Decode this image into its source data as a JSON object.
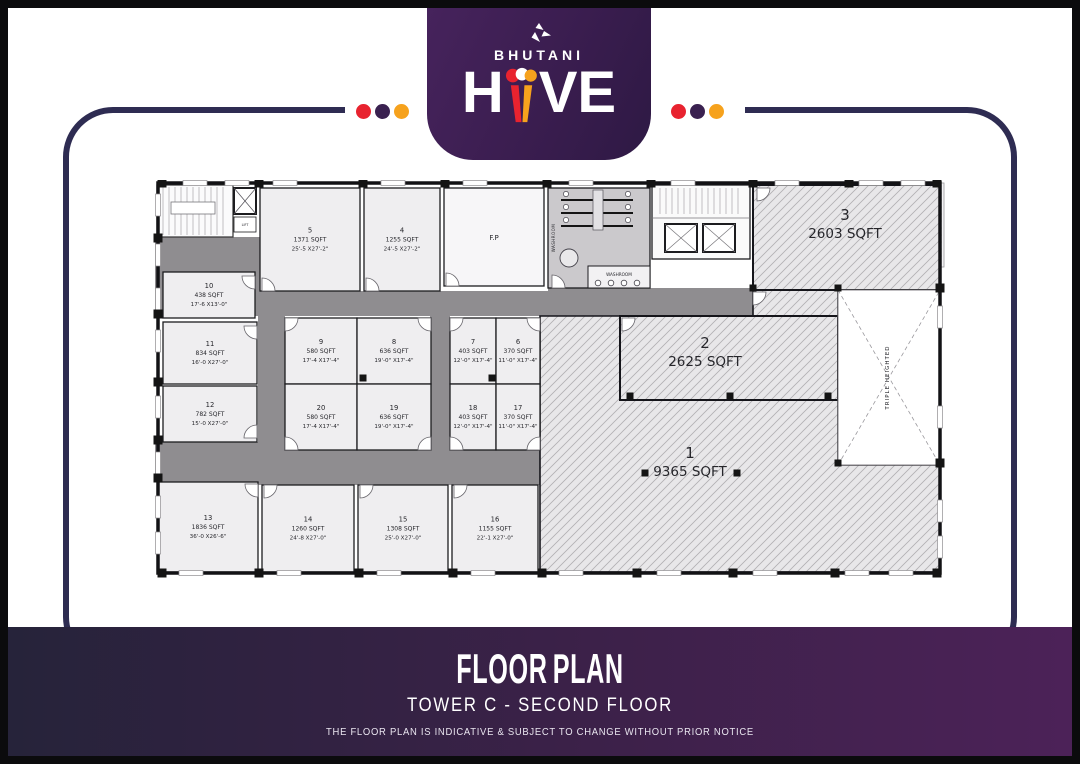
{
  "brand": {
    "name": "BHUTANI",
    "product": "HIVE",
    "hive_h": "H",
    "hive_ve": "VE"
  },
  "header": {
    "dot_colors": [
      "#e8232f",
      "#3a2150",
      "#f6a21d"
    ],
    "line_color": "#2e2c52",
    "badge_color": "#3a1d4f"
  },
  "footer": {
    "title": "FLOOR PLAN",
    "subtitle": "TOWER C - SECOND FLOOR",
    "disclaimer": "THE FLOOR PLAN IS INDICATIVE & SUBJECT TO CHANGE WITHOUT PRIOR NOTICE"
  },
  "floor_plan": {
    "labels": {
      "washroom": "WASHROOM",
      "lift": "LIFT",
      "fp": "F.P",
      "triple_height": "TRIPLE HEIGHTED"
    },
    "fp_room": {
      "label": "F.P",
      "x": 299,
      "y": 8,
      "w": 100,
      "h": 98
    },
    "units": [
      {
        "no": "5",
        "area": "1371 SQFT",
        "dims": "25'-5 X27'-2\"",
        "x": 115,
        "y": 8,
        "w": 100,
        "h": 103
      },
      {
        "no": "4",
        "area": "1255 SQFT",
        "dims": "24'-5 X27'-2\"",
        "x": 219,
        "y": 8,
        "w": 76,
        "h": 103
      },
      {
        "no": "10",
        "area": "438 SQFT",
        "dims": "17'-6 X13'-0\"",
        "x": 18,
        "y": 92,
        "w": 92,
        "h": 46
      },
      {
        "no": "11",
        "area": "834 SQFT",
        "dims": "16'-0 X27'-0\"",
        "x": 18,
        "y": 142,
        "w": 94,
        "h": 62
      },
      {
        "no": "12",
        "area": "782 SQFT",
        "dims": "15'-0 X27'-0\"",
        "x": 18,
        "y": 206,
        "w": 94,
        "h": 56
      },
      {
        "no": "13",
        "area": "1836 SQFT",
        "dims": "36'-0 X26'-6\"",
        "x": 13,
        "y": 302,
        "w": 100,
        "h": 90
      },
      {
        "no": "14",
        "area": "1260 SQFT",
        "dims": "24'-8 X27'-0\"",
        "x": 117,
        "y": 305,
        "w": 92,
        "h": 87
      },
      {
        "no": "15",
        "area": "1308 SQFT",
        "dims": "25'-0 X27'-0\"",
        "x": 213,
        "y": 305,
        "w": 90,
        "h": 87
      },
      {
        "no": "16",
        "area": "1155 SQFT",
        "dims": "22'-1 X27'-0\"",
        "x": 307,
        "y": 305,
        "w": 86,
        "h": 87
      },
      {
        "no": "9",
        "area": "580 SQFT",
        "dims": "17'-4 X17'-4\"",
        "x": 140,
        "y": 138,
        "w": 72,
        "h": 66
      },
      {
        "no": "8",
        "area": "636 SQFT",
        "dims": "19'-0\" X17'-4\"",
        "x": 212,
        "y": 138,
        "w": 74,
        "h": 66
      },
      {
        "no": "20",
        "area": "580 SQFT",
        "dims": "17'-4 X17'-4\"",
        "x": 140,
        "y": 204,
        "w": 72,
        "h": 66
      },
      {
        "no": "19",
        "area": "636 SQFT",
        "dims": "19'-0\" X17'-4\"",
        "x": 212,
        "y": 204,
        "w": 74,
        "h": 66
      },
      {
        "no": "7",
        "area": "403 SQFT",
        "dims": "12'-0\" X17'-4\"",
        "x": 305,
        "y": 138,
        "w": 46,
        "h": 66
      },
      {
        "no": "6",
        "area": "370 SQFT",
        "dims": "11'-0\" X17'-4\"",
        "x": 351,
        "y": 138,
        "w": 44,
        "h": 66
      },
      {
        "no": "18",
        "area": "403 SQFT",
        "dims": "12'-0\" X17'-4\"",
        "x": 305,
        "y": 204,
        "w": 46,
        "h": 66
      },
      {
        "no": "17",
        "area": "370 SQFT",
        "dims": "11'-0\" X17'-4\"",
        "x": 351,
        "y": 204,
        "w": 44,
        "h": 66
      }
    ],
    "big_units": [
      {
        "no": "1",
        "area": "9365 SQFT",
        "shape": "poly",
        "points": "395,136 608,136 608,110 693,110 693,285 795,285 795,392 395,392",
        "tx": 545,
        "ty": 278
      },
      {
        "no": "2",
        "area": "2625 SQFT",
        "shape": "rect",
        "x": 475,
        "y": 136,
        "w": 218,
        "h": 84,
        "tx": 560,
        "ty": 168
      },
      {
        "no": "3",
        "area": "2603 SQFT",
        "shape": "rect",
        "x": 608,
        "y": 5,
        "w": 187,
        "h": 105,
        "tx": 700,
        "ty": 40
      }
    ],
    "triple_height": {
      "x": 693,
      "y": 110,
      "w": 102,
      "h": 175
    },
    "corridors": [
      [
        10,
        57,
        105,
        79
      ],
      [
        113,
        111,
        292,
        25
      ],
      [
        403,
        108,
        205,
        28
      ],
      [
        113,
        136,
        27,
        169
      ],
      [
        113,
        268,
        282,
        37
      ],
      [
        285,
        136,
        20,
        132
      ],
      [
        10,
        262,
        105,
        40
      ]
    ],
    "doors": [
      [
        140,
        138,
        0
      ],
      [
        286,
        138,
        90
      ],
      [
        140,
        270,
        270
      ],
      [
        286,
        270,
        180
      ],
      [
        305,
        138,
        0
      ],
      [
        395,
        138,
        90
      ],
      [
        305,
        270,
        270
      ],
      [
        395,
        270,
        180
      ],
      [
        112,
        146,
        90
      ],
      [
        112,
        258,
        180
      ],
      [
        110,
        96,
        90
      ],
      [
        113,
        304,
        90
      ],
      [
        119,
        305,
        0
      ],
      [
        215,
        305,
        0
      ],
      [
        309,
        305,
        0
      ],
      [
        117,
        111,
        270
      ],
      [
        221,
        111,
        270
      ],
      [
        301,
        106,
        270
      ],
      [
        608,
        112,
        0
      ],
      [
        477,
        138,
        0
      ],
      [
        612,
        8,
        0
      ],
      [
        407,
        108,
        270
      ]
    ],
    "columns": {
      "top_xs": [
        13,
        110,
        214,
        296,
        398,
        502,
        604,
        700,
        788
      ],
      "bottom_xs": [
        13,
        110,
        210,
        304,
        393,
        488,
        584,
        686,
        788
      ],
      "left_ys": [
        58,
        134,
        202,
        260,
        298
      ],
      "right_ys": [
        108,
        283
      ],
      "interior": [
        [
          608,
          108
        ],
        [
          693,
          108
        ],
        [
          693,
          283
        ],
        [
          485,
          216
        ],
        [
          585,
          216
        ],
        [
          683,
          216
        ],
        [
          500,
          293
        ],
        [
          592,
          293
        ],
        [
          218,
          198
        ],
        [
          347,
          198
        ]
      ]
    },
    "windows": {
      "top": [
        38,
        80,
        128,
        236,
        318,
        424,
        526,
        630,
        714,
        756
      ],
      "bottom": [
        34,
        132,
        232,
        326,
        414,
        512,
        608,
        700,
        744
      ],
      "left": [
        14,
        64,
        108,
        150,
        216,
        272,
        316,
        352
      ],
      "right": [
        126,
        226,
        320,
        356
      ]
    }
  }
}
